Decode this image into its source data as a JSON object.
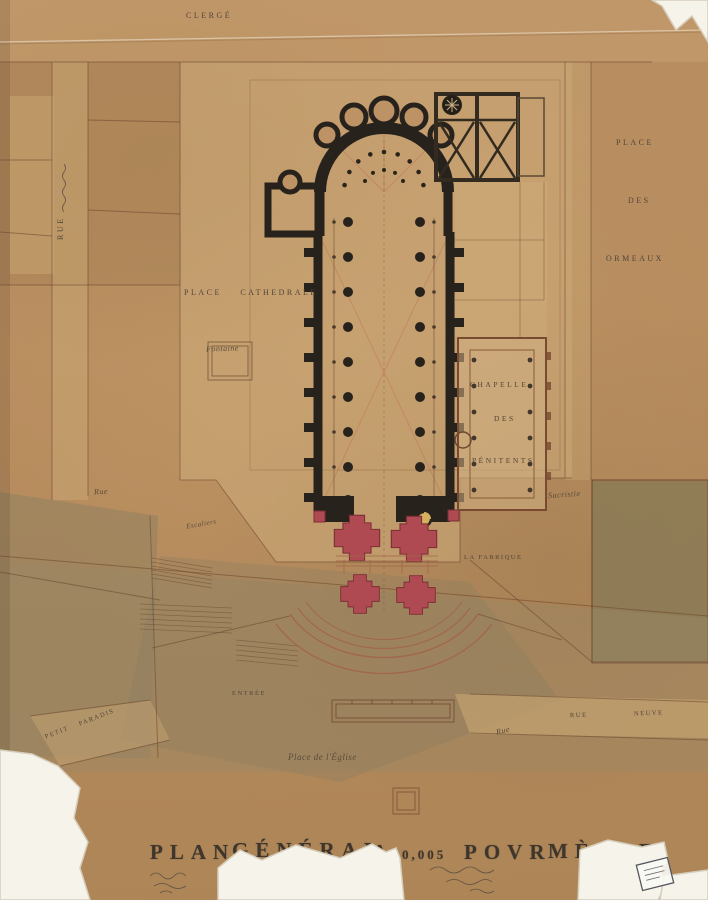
{
  "artwork": {
    "title_full": "PLAN GÉNÉRAL A 0,005 POVR MÈTRE",
    "title_segments": [
      "PLAN",
      "GÉNÉRAL",
      "A",
      "0,005",
      "POVR",
      "MÈTRE"
    ]
  },
  "labels": {
    "clerge": "CLERGÉ",
    "rue_left_vertical": "RUE",
    "place": "PLACE",
    "des": "DES",
    "ormeaux": "ORMEAUX",
    "place_cathedrale": "PLACE CATHEDRALE",
    "fontaine": "Fontaine",
    "chapelle": "CHAPELLE",
    "chapelle_des": "DES",
    "penitents": "PÉNITENTS",
    "sacristie": "Sacristie",
    "la_fabrique": "LA FABRIQUE",
    "rue_cursive_left": "Rue",
    "escaliers": "Escaliers",
    "entree": "ENTRÉE",
    "petit_paradis": "PETIT PARADIS",
    "place_eglise": "Place de l'Église",
    "rue_cursive_bottom": "Rue",
    "rue_bottom": "RUE",
    "neuve": "NEUVE"
  },
  "colors": {
    "paper": "#b98e60",
    "paper_light": "#cbaa78",
    "wash_olive": "#8c7c56",
    "plan_ink": "#28221c",
    "accent_red": "#b04a52",
    "accent_yellow": "#d4b15f",
    "line_sepia": "#7a5237",
    "tear_white": "#f5f3ea",
    "title_ink": "#3e362c"
  }
}
